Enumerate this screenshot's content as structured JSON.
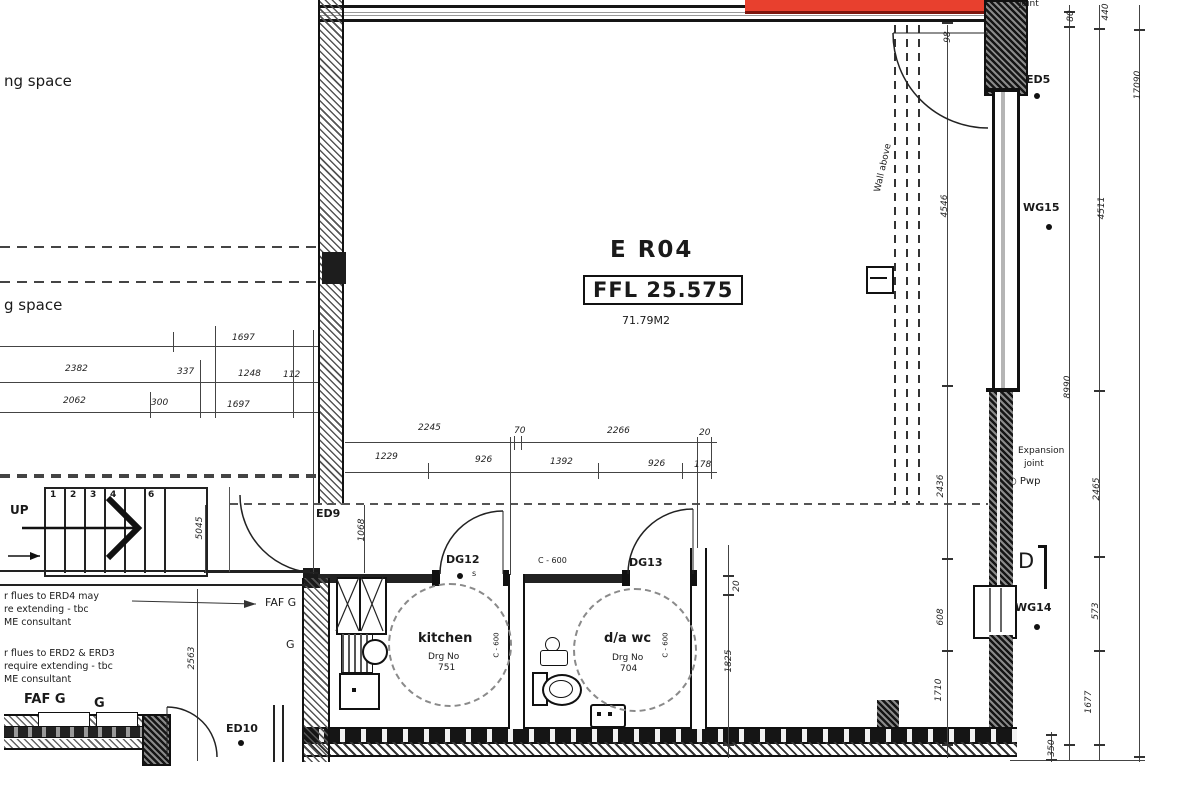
{
  "room": {
    "name": "E R04",
    "ffl": "FFL 25.575",
    "area": "71.79M2"
  },
  "colors": {
    "highlight_red": "#e8402e",
    "highlight_red_dark": "#7d140c",
    "line": "#1a1a1a"
  },
  "stairs": {
    "up_label": "UP",
    "treads": [
      "1",
      "2",
      "3",
      "4",
      "6"
    ]
  },
  "annotations": [
    {
      "name": "parking-space-top-label",
      "text": "ng space",
      "x": 4,
      "y": 74,
      "size": 15
    },
    {
      "name": "parking-space-bottom-label",
      "text": "g space",
      "x": 4,
      "y": 298,
      "size": 15
    },
    {
      "name": "note-flues-1-line1",
      "text": "r flues to ERD4 may",
      "x": 4,
      "y": 592,
      "size": 9.5
    },
    {
      "name": "note-flues-1-line2",
      "text": "re extending - tbc",
      "x": 4,
      "y": 605,
      "size": 9.5
    },
    {
      "name": "note-flues-1-line3",
      "text": "ME consultant",
      "x": 4,
      "y": 618,
      "size": 9.5
    },
    {
      "name": "note-flues-2-line1",
      "text": "r flues to ERD2 & ERD3",
      "x": 4,
      "y": 649,
      "size": 9.5
    },
    {
      "name": "note-flues-2-line2",
      "text": "require extending - tbc",
      "x": 4,
      "y": 662,
      "size": 9.5
    },
    {
      "name": "note-flues-2-line3",
      "text": "ME consultant",
      "x": 4,
      "y": 675,
      "size": 9.5
    },
    {
      "name": "door-ref-ed9",
      "text": "ED9",
      "x": 316,
      "y": 508,
      "size": 11,
      "bold": true
    },
    {
      "name": "faf-g-mid-label",
      "text": "FAF G",
      "x": 265,
      "y": 597,
      "size": 11
    },
    {
      "name": "g-mid-label",
      "text": "G",
      "x": 286,
      "y": 639,
      "size": 11
    },
    {
      "name": "faf-g-bottom-label",
      "text": "FAF G",
      "x": 24,
      "y": 693,
      "size": 13,
      "bold": true
    },
    {
      "name": "g-bottom-label",
      "text": "G",
      "x": 94,
      "y": 697,
      "size": 13,
      "bold": true
    },
    {
      "name": "door-ref-ed10",
      "text": "ED10",
      "x": 226,
      "y": 723,
      "size": 11,
      "bold": true
    },
    {
      "name": "door-ref-dg12",
      "text": "DG12",
      "x": 446,
      "y": 554,
      "size": 11,
      "bold": true
    },
    {
      "name": "dg12-s-marker",
      "text": "s",
      "x": 472,
      "y": 570,
      "size": 8
    },
    {
      "name": "door-ref-dg13",
      "text": "DG13",
      "x": 629,
      "y": 557,
      "size": 11,
      "bold": true
    },
    {
      "name": "c600-corridor-label",
      "text": "C - 600",
      "x": 538,
      "y": 557,
      "size": 8
    },
    {
      "name": "c600-kitchen-label",
      "text": "C - 600",
      "x": 497,
      "y": 645,
      "size": 7,
      "rot": -90
    },
    {
      "name": "c600-wc-label",
      "text": "C - 600",
      "x": 666,
      "y": 645,
      "size": 7,
      "rot": -90
    },
    {
      "name": "kitchen-label",
      "text": "kitchen",
      "x": 418,
      "y": 632,
      "size": 13,
      "bold": true
    },
    {
      "name": "kitchen-drgno-label",
      "text": "Drg No",
      "x": 428,
      "y": 653,
      "size": 9
    },
    {
      "name": "kitchen-drgno-value",
      "text": "751",
      "x": 438,
      "y": 664,
      "size": 9
    },
    {
      "name": "dawc-label",
      "text": "d/a wc",
      "x": 604,
      "y": 632,
      "size": 13,
      "bold": true
    },
    {
      "name": "dawc-drgno-label",
      "text": "Drg No",
      "x": 612,
      "y": 654,
      "size": 9
    },
    {
      "name": "dawc-drgno-value",
      "text": "704",
      "x": 620,
      "y": 665,
      "size": 9
    },
    {
      "name": "wall-above-label",
      "text": "Wall above",
      "x": 884,
      "y": 168,
      "size": 9,
      "rot": -77
    },
    {
      "name": "door-ref-ed5",
      "text": "ED5",
      "x": 1026,
      "y": 74,
      "size": 11,
      "bold": true
    },
    {
      "name": "window-ref-wg15",
      "text": "WG15",
      "x": 1023,
      "y": 202,
      "size": 11,
      "bold": true
    },
    {
      "name": "expansion-joint-label-line1",
      "text": "Expansion",
      "x": 1018,
      "y": 447,
      "size": 9
    },
    {
      "name": "expansion-joint-label-line2",
      "text": "joint",
      "x": 1024,
      "y": 460,
      "size": 9
    },
    {
      "name": "rwp-label",
      "text": "○ Pwp",
      "x": 1008,
      "y": 477,
      "size": 10
    },
    {
      "name": "section-marker-d",
      "text": "D",
      "x": 1018,
      "y": 550,
      "size": 21
    },
    {
      "name": "window-ref-wg14",
      "text": "WG14",
      "x": 1015,
      "y": 602,
      "size": 11,
      "bold": true
    },
    {
      "name": "joint-top-label",
      "text": "joint",
      "x": 1019,
      "y": 0,
      "size": 9
    }
  ],
  "dimensions": [
    {
      "v": "1697",
      "x": 232,
      "y": 333
    },
    {
      "v": "2382",
      "x": 65,
      "y": 364
    },
    {
      "v": "337",
      "x": 177,
      "y": 367
    },
    {
      "v": "1248",
      "x": 238,
      "y": 369
    },
    {
      "v": "112",
      "x": 283,
      "y": 370
    },
    {
      "v": "2062",
      "x": 63,
      "y": 396
    },
    {
      "v": "300",
      "x": 151,
      "y": 398
    },
    {
      "v": "1697",
      "x": 227,
      "y": 400
    },
    {
      "v": "2245",
      "x": 418,
      "y": 423
    },
    {
      "v": "70",
      "x": 514,
      "y": 426
    },
    {
      "v": "2266",
      "x": 607,
      "y": 426
    },
    {
      "v": "20",
      "x": 699,
      "y": 428
    },
    {
      "v": "1229",
      "x": 375,
      "y": 452
    },
    {
      "v": "926",
      "x": 475,
      "y": 455
    },
    {
      "v": "1392",
      "x": 550,
      "y": 457
    },
    {
      "v": "926",
      "x": 648,
      "y": 459
    },
    {
      "v": "178",
      "x": 694,
      "y": 460
    },
    {
      "v": "5045",
      "x": 200,
      "y": 528,
      "rot": true
    },
    {
      "v": "1068",
      "x": 362,
      "y": 530,
      "rot": true
    },
    {
      "v": "2563",
      "x": 192,
      "y": 658,
      "rot": true
    },
    {
      "v": "98",
      "x": 948,
      "y": 37,
      "rot": true
    },
    {
      "v": "80",
      "x": 1071,
      "y": 16,
      "rot": true
    },
    {
      "v": "440",
      "x": 1106,
      "y": 12,
      "rot": true
    },
    {
      "v": "17090",
      "x": 1138,
      "y": 85,
      "rot": true
    },
    {
      "v": "4546",
      "x": 945,
      "y": 206,
      "rot": true
    },
    {
      "v": "4511",
      "x": 1102,
      "y": 208,
      "rot": true
    },
    {
      "v": "8990",
      "x": 1068,
      "y": 387,
      "rot": true
    },
    {
      "v": "2436",
      "x": 941,
      "y": 486,
      "rot": true
    },
    {
      "v": "2465",
      "x": 1097,
      "y": 489,
      "rot": true
    },
    {
      "v": "608",
      "x": 941,
      "y": 617,
      "rot": true
    },
    {
      "v": "573",
      "x": 1096,
      "y": 611,
      "rot": true
    },
    {
      "v": "1710",
      "x": 939,
      "y": 690,
      "rot": true
    },
    {
      "v": "1677",
      "x": 1089,
      "y": 702,
      "rot": true
    },
    {
      "v": "1825",
      "x": 729,
      "y": 661,
      "rot": true
    },
    {
      "v": "20",
      "x": 737,
      "y": 586,
      "rot": true
    },
    {
      "v": "350",
      "x": 1052,
      "y": 748,
      "rot": true
    }
  ]
}
